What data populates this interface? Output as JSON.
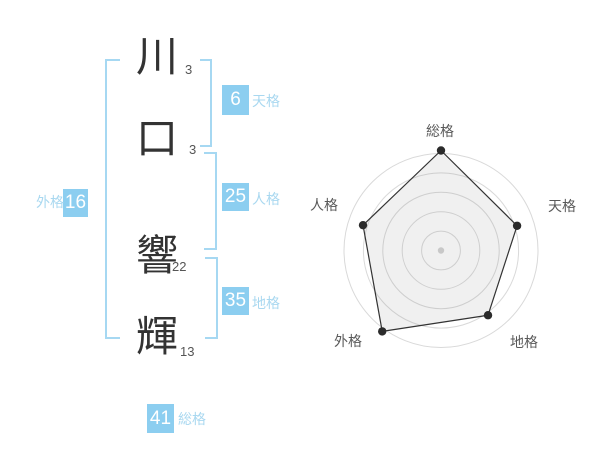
{
  "name": {
    "characters": [
      {
        "char": "川",
        "strokes": 3
      },
      {
        "char": "口",
        "strokes": 3
      },
      {
        "char": "響",
        "strokes": 22
      },
      {
        "char": "輝",
        "strokes": 13
      }
    ]
  },
  "gokaku": {
    "tenkaku": {
      "label": "天格",
      "value": 6
    },
    "jinkaku": {
      "label": "人格",
      "value": 25
    },
    "chikaku": {
      "label": "地格",
      "value": 35
    },
    "gaikaku": {
      "label": "外格",
      "value": 16
    },
    "soukaku": {
      "label": "総格",
      "value": 41
    }
  },
  "chart_data": {
    "type": "radar",
    "categories": [
      "総格",
      "天格",
      "地格",
      "外格",
      "人格"
    ],
    "values": [
      100,
      80,
      80,
      100,
      82
    ],
    "max": 100,
    "rings": 5,
    "start_angle_deg": -90,
    "legend": "none",
    "colors": {
      "ring": "#d9d9d9",
      "line": "#333333",
      "fill": "rgba(130,130,130,0.12)",
      "point": "#2b2b2b",
      "center_dot": "#c8c8c8"
    }
  },
  "colors": {
    "accent_blue": "#8ccef0",
    "label_blue": "#a9d8f0",
    "bracket_blue": "#a6d8f2",
    "text_dark": "#333333",
    "stroke_gray": "#555555"
  }
}
